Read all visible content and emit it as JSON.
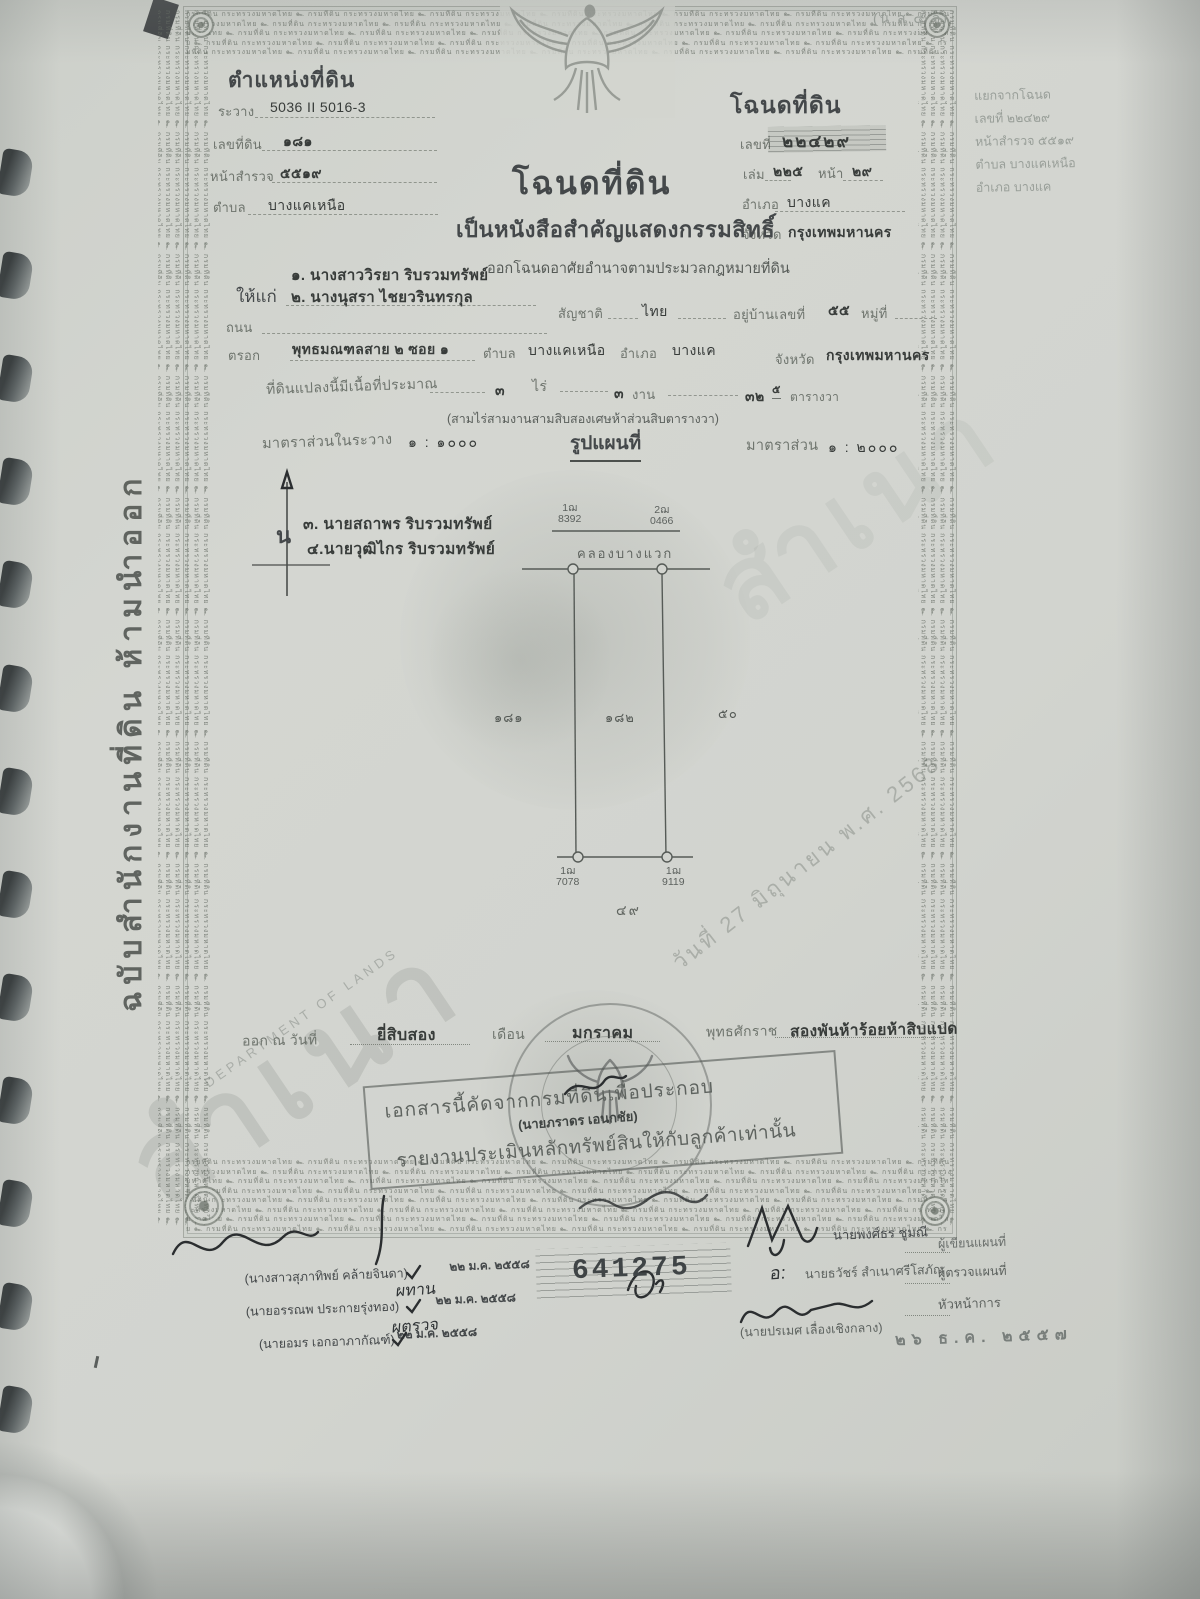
{
  "colors": {
    "paper": "#d2d4cf",
    "ink": "#3b3e3c",
    "stamp_gray": "#5c605e",
    "faint_gray": "#9aa09a"
  },
  "corner_tag": "(น.ส.๔ จ)",
  "header_left": {
    "title": "ตำแหน่งที่ดิน",
    "ravang_label": "ระวาง",
    "ravang": "5036 II 5016-3",
    "landno_label": "เลขที่ดิน",
    "landno": "๑๘๑",
    "survey_label": "หน้าสำรวจ",
    "survey": "๕๕๑๙",
    "tambon_label": "ตำบล",
    "tambon": "บางแคเหนือ"
  },
  "header_right": {
    "title": "โฉนดที่ดิน",
    "no_label": "เลขที่",
    "no": "๒๒๔๒๙",
    "book_label": "เล่ม",
    "book": "๒๒๕",
    "page_label": "หน้า",
    "page": "๒๙",
    "amphoe_label": "อำเภอ",
    "amphoe": "บางแค",
    "province_label": "จังหวัด",
    "province": "กรุงเทพมหานคร"
  },
  "side_note": {
    "line1": "แยกจากโฉนด",
    "line2": "เลขที่ ๒๒๔๒๙",
    "line3": "หน้าสำรวจ ๕๕๑๙",
    "line4": "ตำบล บางแคเหนือ",
    "line5": "อำเภอ บางแค"
  },
  "title_block": {
    "main": "โฉนดที่ดิน",
    "sub": "เป็นหนังสือสำคัญแสดงกรรมสิทธิ์",
    "legal": "ออกโฉนดอาศัยอำนาจตามประมวลกฎหมายที่ดิน"
  },
  "grantees": {
    "label": "ให้แก่",
    "name1": "๑. นางสาววิรยา ริบรวมทรัพย์",
    "name2": "๒. นางนุสรา ไชยวรินทรกุล",
    "nationality_label": "สัญชาติ",
    "nationality": "ไทย",
    "house_label": "อยู่บ้านเลขที่",
    "house_no": "๕๕",
    "moo_label": "หมู่ที่",
    "road_label": "ถนน",
    "soi_label": "ตรอก",
    "soi": "พุทธมณฑลสาย ๒ ซอย ๑",
    "tambon_label": "ตำบล",
    "tambon": "บางแคเหนือ",
    "amphoe_label": "อำเภอ",
    "amphoe": "บางแค",
    "province_label": "จังหวัด",
    "province": "กรุงเทพมหานคร"
  },
  "area": {
    "label": "ที่ดินแปลงนี้มีเนื้อที่ประมาณ",
    "rai": "๓",
    "rai_unit": "ไร่",
    "ngan": "๓",
    "ngan_unit": "งาน",
    "wa": "๓๒",
    "wa_frac": "๕",
    "wa_unit": "ตารางวา",
    "words": "(สามไร่สามงานสามสิบสองเศษห้าส่วนสิบตารางวา)"
  },
  "scale": {
    "in_label": "มาตราส่วนในระวาง",
    "in_value": "๑ : ๑๐๐๐",
    "map_title": "รูปแผนที่",
    "out_label": "มาตราส่วน",
    "out_value": "๑ : ๒๐๐๐"
  },
  "map": {
    "north": "น",
    "adj1": "๓. นายสถาพร ริบรวมทรัพย์",
    "adj2": "๔.นายวุฒิไกร ริบรวมทรัพย์",
    "m_tl1": "1ฌ",
    "m_tl2": "8392",
    "m_tr1": "2ฌ",
    "m_tr2": "0466",
    "canal": "คลองบางแวก",
    "plot_left": "๑๘๑",
    "plot_mid": "๑๘๒",
    "plot_right": "๕๐",
    "m_bl1": "1ฌ",
    "m_bl2": "7078",
    "m_br1": "1ฌ",
    "m_br2": "9119",
    "baseline_no": "๔๙"
  },
  "issue": {
    "prefix": "ออก ณ วันที่",
    "day": "ยี่สิบสอง",
    "month_label": "เดือน",
    "month": "มกราคม",
    "era_label": "พุทธศักราช",
    "year": "สองพันห้าร้อยห้าสิบแปด"
  },
  "stamp_box": {
    "line1": "เอกสารนี้คัดจากกรมที่ดินเพื่อประกอบ",
    "officer": "(นายภราดร เอนกชัย)",
    "line2": "รายงานประเมินหลักทรัพย์สินให้กับลูกค้าเท่านั้น"
  },
  "serial": "641275",
  "sign_left": {
    "rows": [
      {
        "name": "(นางสาวสุภาทิพย์ คล้ายจินดา)",
        "date": "๒๒ ม.ค. ๒๕๕๘"
      },
      {
        "name": "(นายอรรณพ ประกายรุ่งทอง)",
        "date": "๒๒ ม.ค. ๒๕๕๘"
      },
      {
        "name": "(นายอมร เอกอาภากัณฑ์)",
        "date": "๒๒ ม.ค. ๒๕๕๘"
      }
    ],
    "hand1": "ผทาน",
    "hand2": "ผตรวจ"
  },
  "sign_right": {
    "name1": "นายพงศ์ธร ชูมณี",
    "role1": "ผู้เขียนแผนที่",
    "hand_prefix": "อ:",
    "name2": "นายธวัชร์ สำเนาศรีโสภัณ",
    "role2": "ผู้ตรวจแผนที่",
    "role3": "หัวหน้าการ",
    "name3": "(นายปรเมศ เลื่องเชิงกลาง)",
    "date_stamp": "๒๖ ธ.ค. ๒๕๕๗"
  },
  "margin_text": "ฉบับสำนักงานที่ดิน    ห้ามนำออก",
  "watermarks": {
    "copy": "สำเนา",
    "date_diag": "วันที่ 27 มิถุนายน พ.ศ. 2568",
    "dept": "DEPARTMENT OF LANDS"
  },
  "microtext": {
    "pattern": "กรมที่ดิน กระทรวงมหาดไทย ๛ "
  }
}
